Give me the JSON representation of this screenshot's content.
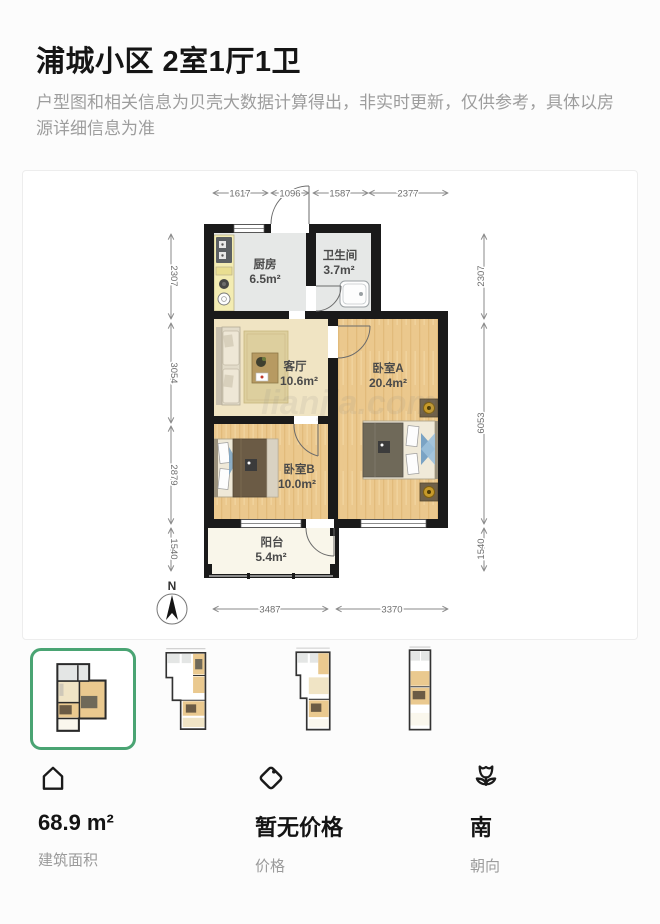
{
  "header": {
    "title": "浦城小区 2室1厅1卫",
    "disclaimer": "户型图和相关信息为贝壳大数据计算得出，非实时更新，仅供参考，具体以房源详细信息为准"
  },
  "floor_plan": {
    "watermark": "lianjia.com",
    "north_label": "N",
    "rooms": [
      {
        "name": "厨房",
        "area": "6.5m²"
      },
      {
        "name": "卫生间",
        "area": "3.7m²"
      },
      {
        "name": "客厅",
        "area": "10.6m²"
      },
      {
        "name": "卧室A",
        "area": "20.4m²"
      },
      {
        "name": "卧室B",
        "area": "10.0m²"
      },
      {
        "name": "阳台",
        "area": "5.4m²"
      }
    ],
    "dimensions": {
      "top": [
        "1617",
        "1096",
        "1587",
        "2377"
      ],
      "left": [
        "2307",
        "3054",
        "2879",
        "1540"
      ],
      "right": [
        "2307",
        "6053",
        "1540"
      ],
      "bottom": [
        "3487",
        "3370"
      ]
    }
  },
  "thumbnails": {
    "count": 4,
    "selected_index": 0,
    "accent_color": "#4aa473"
  },
  "stats": [
    {
      "icon": "house-icon",
      "value": "68.9 m²",
      "label": "建筑面积"
    },
    {
      "icon": "tag-icon",
      "value": "暂无价格",
      "label": "价格"
    },
    {
      "icon": "flower-icon",
      "value": "南",
      "label": "朝向"
    }
  ]
}
